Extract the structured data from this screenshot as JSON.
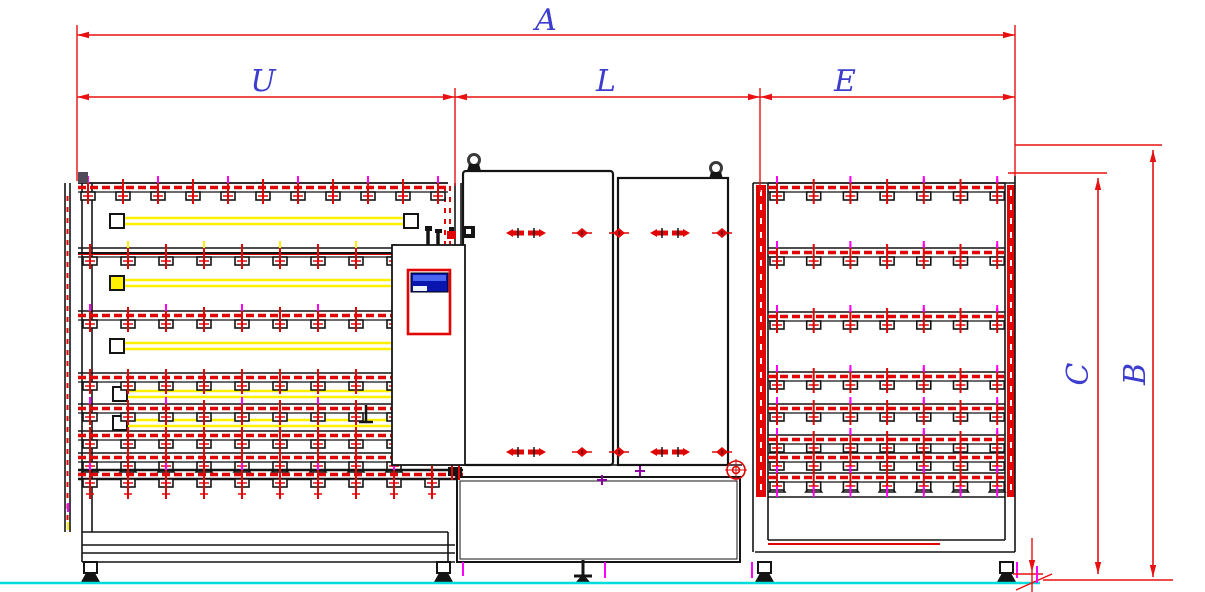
{
  "page": {
    "type": "engineering-drawing",
    "description": "Front elevation CAD drawing of a vertical glass washing line: infeed tilting conveyor (U), washing machine cabin (L), outfeed conveyor (E); overall length A; machine heights B and C measured from floor level."
  },
  "labels": {
    "A": "A",
    "U": "U",
    "L": "L",
    "E": "E",
    "B": "B",
    "C": "C"
  },
  "colors": {
    "dim": "#e81010",
    "label": "#3c3ccd",
    "ink": "#141414",
    "red": "#e00606",
    "magenta": "#ff00ff",
    "purple": "#8a00a0",
    "yellow": "#ffef00",
    "cyan": "#00dcdc",
    "screen": "#0a15b0",
    "screenhi": "#4a66f0",
    "screenlite": "#eef1ff",
    "gray": "#3a3a3a",
    "white": "#ffffff"
  },
  "drawing": {
    "canvas": {
      "w": 1205,
      "h": 592
    },
    "floor": {
      "x1": 0,
      "x2": 1040,
      "y": 583
    },
    "hdims": [
      {
        "key": "A",
        "x1": 77,
        "x2": 1015,
        "y": 35
      },
      {
        "key": "U",
        "x1": 77,
        "x2": 455,
        "y": 97
      },
      {
        "key": "L",
        "x1": 455,
        "x2": 760,
        "y": 97
      },
      {
        "key": "E",
        "x1": 760,
        "x2": 1015,
        "y": 97
      }
    ],
    "vdims": [
      {
        "key": "B",
        "x": 1153,
        "y1": 150,
        "y2": 577
      },
      {
        "key": "C",
        "x": 1098,
        "y1": 178,
        "y2": 574
      }
    ],
    "ext_lines": [
      [
        77,
        25,
        77,
        181
      ],
      [
        1015,
        25,
        1015,
        176
      ],
      [
        455,
        88,
        455,
        186
      ],
      [
        760,
        88,
        760,
        192
      ],
      [
        1015,
        145,
        1162,
        145
      ],
      [
        1008,
        173,
        1107,
        173
      ],
      [
        1043,
        580,
        1173,
        580
      ],
      [
        1013,
        574,
        1043,
        574
      ],
      [
        1016,
        590,
        1052,
        574
      ],
      [
        1032,
        538,
        1032,
        592
      ]
    ],
    "datum_arrow": {
      "x": 1032,
      "y": 572
    },
    "datum_tick_magenta": [
      1037,
      566,
      1037,
      583
    ],
    "left_conveyor": {
      "frame_lines": [
        [
          65,
          183,
          65,
          532
        ],
        [
          70,
          183,
          70,
          532
        ],
        [
          82,
          183,
          82,
          562
        ],
        [
          92,
          183,
          92,
          532
        ],
        [
          82,
          532,
          448,
          532
        ],
        [
          82,
          545,
          455,
          545
        ],
        [
          82,
          553,
          455,
          553
        ],
        [
          82,
          562,
          455,
          562
        ],
        [
          448,
          532,
          448,
          562
        ],
        [
          78,
          183,
          448,
          183
        ],
        [
          455,
          183,
          455,
          245
        ],
        [
          461,
          183,
          461,
          245
        ]
      ],
      "red_dash_lines": [
        [
          67.5,
          196,
          67.5,
          524
        ],
        [
          445,
          186,
          445,
          244
        ],
        [
          450,
          186,
          450,
          244
        ]
      ],
      "rails": [
        {
          "y": 188,
          "x1": 78,
          "x2": 448,
          "start": 88,
          "n": 11,
          "step": 35,
          "style": "red",
          "mticks": true
        },
        {
          "y": 253,
          "x1": 78,
          "x2": 392,
          "start": 90,
          "n": 9,
          "step": 38,
          "style": "black",
          "yticks": true
        },
        {
          "y": 316,
          "x1": 78,
          "x2": 392,
          "start": 90,
          "n": 9,
          "step": 38,
          "style": "red",
          "mticks": true
        },
        {
          "y": 378,
          "x1": 78,
          "x2": 392,
          "start": 90,
          "n": 9,
          "step": 38,
          "style": "red"
        },
        {
          "y": 409,
          "x1": 78,
          "x2": 392,
          "start": 90,
          "n": 9,
          "step": 38,
          "style": "red",
          "mticks": true
        },
        {
          "y": 436,
          "x1": 78,
          "x2": 392,
          "start": 90,
          "n": 9,
          "step": 38,
          "style": "red"
        },
        {
          "y": 458,
          "x1": 78,
          "x2": 400,
          "start": 90,
          "n": 9,
          "step": 38,
          "style": "tri"
        },
        {
          "y": 475,
          "x1": 78,
          "x2": 463,
          "start": 90,
          "n": 10,
          "step": 38,
          "style": "heavy",
          "mticks": true
        }
      ],
      "lamps": [
        {
          "y": 221,
          "x1": 124,
          "x2": 404,
          "boxes": [
            110,
            404
          ],
          "boxfill": "white"
        },
        {
          "y": 283,
          "x1": 124,
          "x2": 392,
          "boxes": [
            110
          ],
          "boxfill": "yellow"
        },
        {
          "y": 346,
          "x1": 124,
          "x2": 392,
          "boxes": [
            110
          ],
          "boxfill": "white"
        },
        {
          "y": 394,
          "x1": 127,
          "x2": 392,
          "boxes": [
            113
          ],
          "boxfill": "white"
        },
        {
          "y": 423,
          "x1": 127,
          "x2": 392,
          "boxes": [
            113
          ],
          "boxfill": "white"
        }
      ],
      "legs": [
        84,
        437
      ],
      "corner_block": {
        "x": 78,
        "y": 172,
        "w": 10,
        "h": 11
      },
      "sensor_bracket": [
        [
          366,
          405,
          366,
          422
        ],
        [
          359,
          422,
          373,
          422
        ]
      ],
      "ticks": [
        {
          "l": [
            68,
            503,
            68,
            512
          ],
          "c": "magenta"
        },
        {
          "l": [
            68,
            522,
            68,
            530
          ],
          "c": "yellow"
        }
      ]
    },
    "washer": {
      "cabinet": {
        "x": 392,
        "y": 245,
        "w": 73,
        "h": 220
      },
      "hmi_frame": {
        "x": 408,
        "y": 270,
        "w": 42,
        "h": 64
      },
      "hmi_screen": {
        "x": 411,
        "y": 273,
        "w": 37,
        "h": 19
      },
      "door_left": {
        "x": 463,
        "y": 171,
        "w": 150,
        "h": 294
      },
      "door_right": {
        "x": 618,
        "y": 178,
        "w": 110,
        "h": 287
      },
      "eyebolts": [
        {
          "cx": 474,
          "cy": 160
        },
        {
          "cx": 716,
          "cy": 168
        }
      ],
      "fastener_rows": [
        233,
        452
      ],
      "fastener_pairs": [
        526,
        670
      ],
      "fastener_dots": [
        582,
        619,
        722
      ],
      "base_band": {
        "x1": 455,
        "x2": 742,
        "y1": 465,
        "y2": 477
      },
      "tank": {
        "x": 457,
        "y": 477,
        "w": 283,
        "h": 85
      },
      "tank_inner": {
        "x": 460,
        "y": 481,
        "w": 277,
        "h": 78
      },
      "target": {
        "cx": 736,
        "cy": 470,
        "r1": 9,
        "r2": 3.5
      },
      "pipes": [
        [
          428,
          230,
          428,
          245
        ],
        [
          438,
          232,
          438,
          245
        ]
      ],
      "pipe_caps": [
        [
          425,
          226,
          7,
          5
        ],
        [
          435,
          229,
          7,
          4
        ],
        [
          449,
          227,
          5,
          4
        ]
      ],
      "red_block": [
        447,
        231,
        9,
        8
      ],
      "edge_block": {
        "x": 463,
        "y": 226,
        "w": 12,
        "h": 12
      },
      "junction_block": [
        448,
        467,
        14,
        9
      ],
      "junction_red": [
        [
          452,
          463,
          452,
          480
        ],
        [
          459,
          463,
          459,
          480
        ]
      ],
      "purple_crosses": [
        [
          602,
          480
        ],
        [
          640,
          471
        ]
      ],
      "center_jack": 583,
      "magenta_ticks": [
        [
          463,
          562,
          463,
          576
        ],
        [
          605,
          562,
          605,
          578
        ]
      ]
    },
    "right_conveyor": {
      "frame_lines": [
        [
          753,
          183,
          753,
          552
        ],
        [
          768,
          183,
          768,
          540
        ],
        [
          1005,
          183,
          1005,
          540
        ],
        [
          1015,
          176,
          1015,
          552
        ],
        [
          753,
          183,
          1015,
          183
        ],
        [
          768,
          540,
          1005,
          540
        ],
        [
          755,
          552,
          1015,
          552
        ],
        [
          768,
          497,
          1005,
          497
        ]
      ],
      "red_line": [
        768,
        544,
        940,
        544
      ],
      "stripes": [
        {
          "x": 756,
          "y": 185,
          "w": 10,
          "h": 312
        },
        {
          "x": 1007,
          "y": 185,
          "w": 8,
          "h": 312
        }
      ],
      "rails": [
        {
          "y": 188,
          "x1": 768,
          "x2": 1005,
          "start": 777,
          "n": 7,
          "step": 36.7,
          "style": "red",
          "mticks": true
        },
        {
          "y": 253,
          "x1": 768,
          "x2": 1005,
          "start": 777,
          "n": 7,
          "step": 36.7,
          "style": "red",
          "mticks": true
        },
        {
          "y": 317,
          "x1": 768,
          "x2": 1005,
          "start": 777,
          "n": 7,
          "step": 36.7,
          "style": "red",
          "mticks": true
        },
        {
          "y": 377,
          "x1": 768,
          "x2": 1005,
          "start": 777,
          "n": 7,
          "step": 36.7,
          "style": "red",
          "mticks": true
        },
        {
          "y": 409,
          "x1": 768,
          "x2": 1005,
          "start": 777,
          "n": 7,
          "step": 36.7,
          "style": "red",
          "mticks": true
        },
        {
          "y": 440,
          "x1": 768,
          "x2": 1005,
          "start": 777,
          "n": 7,
          "step": 36.7,
          "style": "red",
          "mticks": true
        },
        {
          "y": 458,
          "x1": 768,
          "x2": 1005,
          "start": 777,
          "n": 7,
          "step": 36.7,
          "style": "red"
        },
        {
          "y": 478,
          "x1": 768,
          "x2": 1005,
          "start": 777,
          "n": 7,
          "step": 36.7,
          "style": "tri",
          "mticks": true
        }
      ],
      "foot_ticks_y": [
        486,
        497
      ],
      "legs": [
        758,
        1000
      ],
      "magenta_ticks": [
        [
          752,
          562,
          752,
          578
        ],
        [
          1017,
          562,
          1017,
          578
        ]
      ]
    }
  }
}
